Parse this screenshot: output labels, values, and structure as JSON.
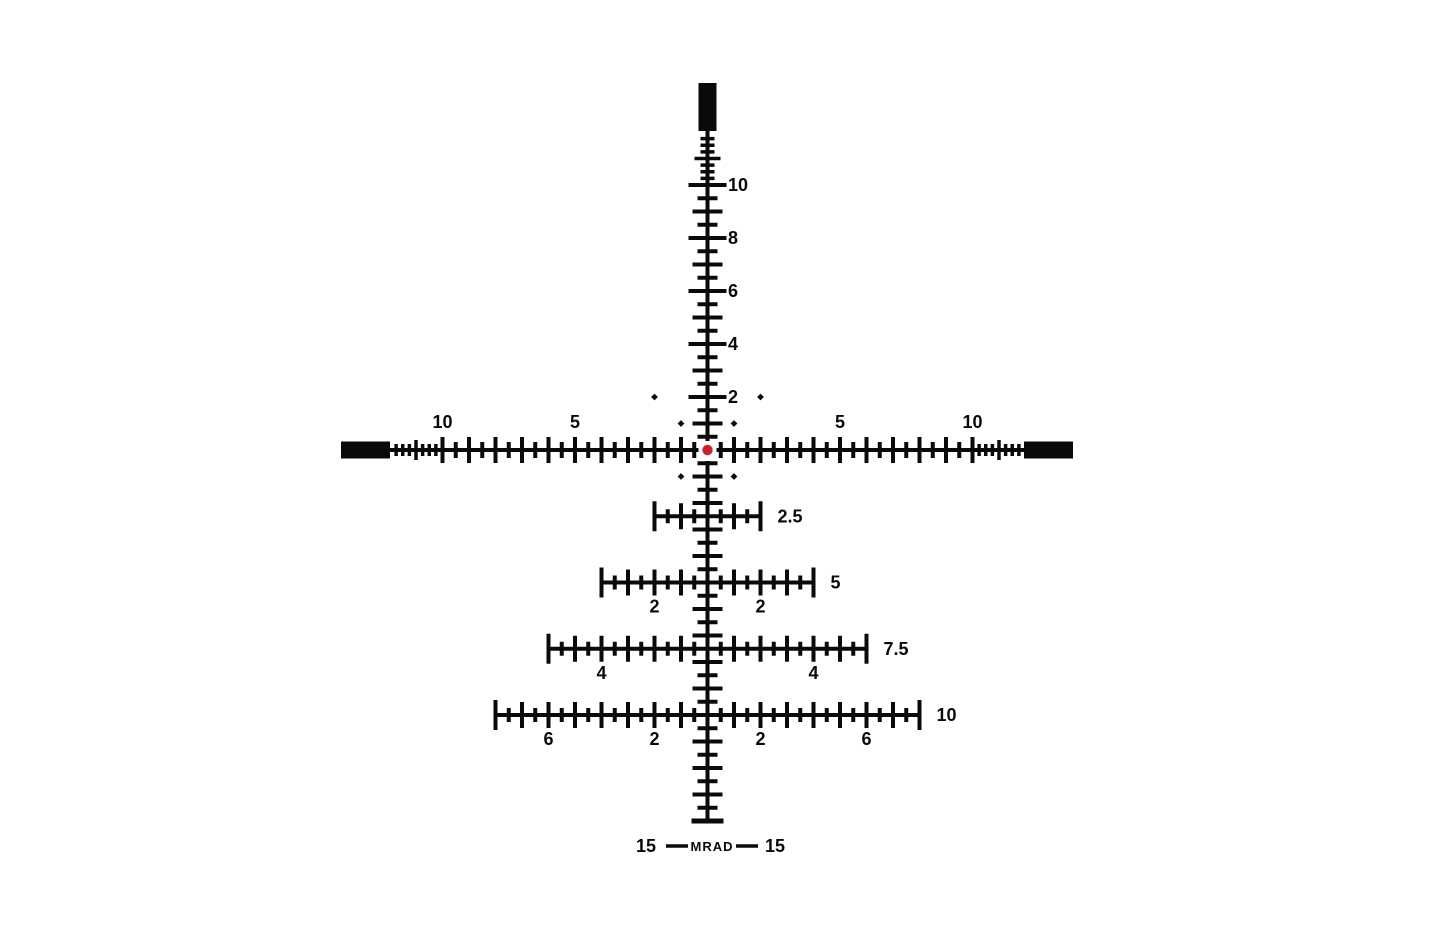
{
  "reticle": {
    "type": "mrad-holdover-tree-reticle",
    "unit": "MRAD",
    "px_per_mrad": 26.5,
    "colors": {
      "ink": "#0a0a0a",
      "background": "#ffffff",
      "center_dot": "#d01f27"
    },
    "center_dot": {
      "shape": "circle",
      "radius_px": 5.2
    },
    "posts": {
      "top": true,
      "left": true,
      "right": true,
      "bottom": false
    },
    "elevation_scale": {
      "half_tick_step_mrad": 0.5,
      "fine_tick_step_mrad": 0.25,
      "fine_tick_range_mrad": [
        10.25,
        11.75
      ],
      "labels": [
        {
          "mrad": 10,
          "text": "10"
        },
        {
          "mrad": 8,
          "text": "8"
        },
        {
          "mrad": 6,
          "text": "6"
        },
        {
          "mrad": 4,
          "text": "4"
        },
        {
          "mrad": 2,
          "text": "2"
        }
      ],
      "lower_end_cap_mrad": 14
    },
    "windage_scale": {
      "half_tick_step_mrad": 0.5,
      "fine_tick_step_mrad": 0.25,
      "fine_tick_range_mrad": [
        10.25,
        11.75
      ],
      "labels": [
        {
          "mrad": -10,
          "text": "10"
        },
        {
          "mrad": -5,
          "text": "5"
        },
        {
          "mrad": 5,
          "text": "5"
        },
        {
          "mrad": 10,
          "text": "10"
        }
      ]
    },
    "holdover_bars": [
      {
        "mrad_down": 2.5,
        "half_width_mrad": 2,
        "label": "2.5",
        "sub_labels": []
      },
      {
        "mrad_down": 5,
        "half_width_mrad": 4,
        "label": "5",
        "sub_labels": [
          {
            "mrad": -2,
            "text": "2"
          },
          {
            "mrad": 2,
            "text": "2"
          }
        ]
      },
      {
        "mrad_down": 7.5,
        "half_width_mrad": 6,
        "label": "7.5",
        "sub_labels": [
          {
            "mrad": -4,
            "text": "4"
          },
          {
            "mrad": 4,
            "text": "4"
          }
        ]
      },
      {
        "mrad_down": 10,
        "half_width_mrad": 8,
        "label": "10",
        "sub_labels": [
          {
            "mrad": -6,
            "text": "6"
          },
          {
            "mrad": -2,
            "text": "2"
          },
          {
            "mrad": 2,
            "text": "2"
          },
          {
            "mrad": 6,
            "text": "6"
          }
        ]
      }
    ],
    "reference_dots_mrad": [
      [
        -2,
        -2
      ],
      [
        2,
        -2
      ],
      [
        -1,
        -1
      ],
      [
        1,
        -1
      ],
      [
        -1,
        1
      ],
      [
        1,
        1
      ]
    ],
    "bottom_legend": {
      "left": "15",
      "unit": "MRAD",
      "right": "15"
    }
  }
}
